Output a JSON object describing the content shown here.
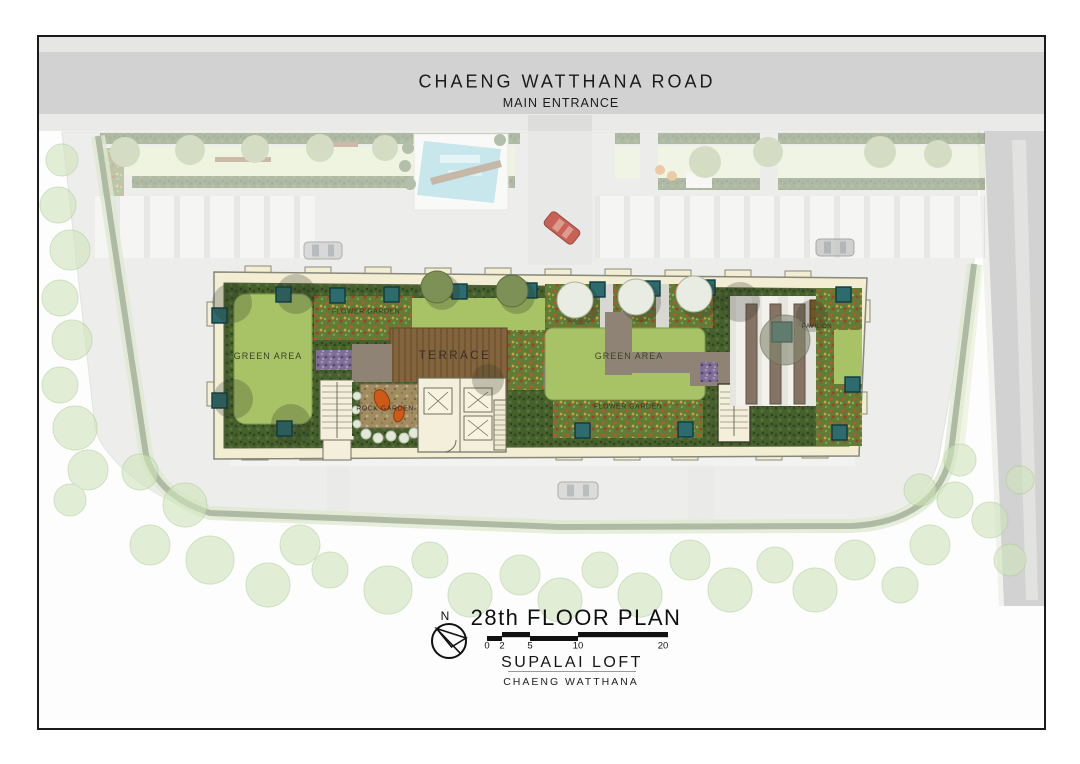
{
  "header": {
    "road_name": "CHAENG  WATTHANA  ROAD",
    "entrance_label": "MAIN ENTRANCE"
  },
  "plan_labels": {
    "green_area_left": "GREEN AREA",
    "flower_garden_upper": "FLOWER GARDEN",
    "terrace": "TERRACE",
    "rock_garden": "ROCK GARDEN",
    "green_area_right": "GREEN AREA",
    "flower_garden_lower": "FLOWER GARDEN",
    "pavilion": "PAVILION"
  },
  "title_block": {
    "north_label": "N",
    "title": "28th FLOOR PLAN",
    "scale_ticks": [
      "0",
      "2",
      "5",
      "10",
      "20"
    ],
    "project_name": "SUPALAI LOFT",
    "project_subtitle": "CHAENG  WATTHANA"
  },
  "colors": {
    "road": "#d2d2d2",
    "lawn": "#a8c266",
    "hedge": "#45602c",
    "wood": "#83643c",
    "pool": "#7fc9d9",
    "teal": "#2d6b6e",
    "rock": "#cd5a17",
    "car_red": "#c23b2e"
  }
}
